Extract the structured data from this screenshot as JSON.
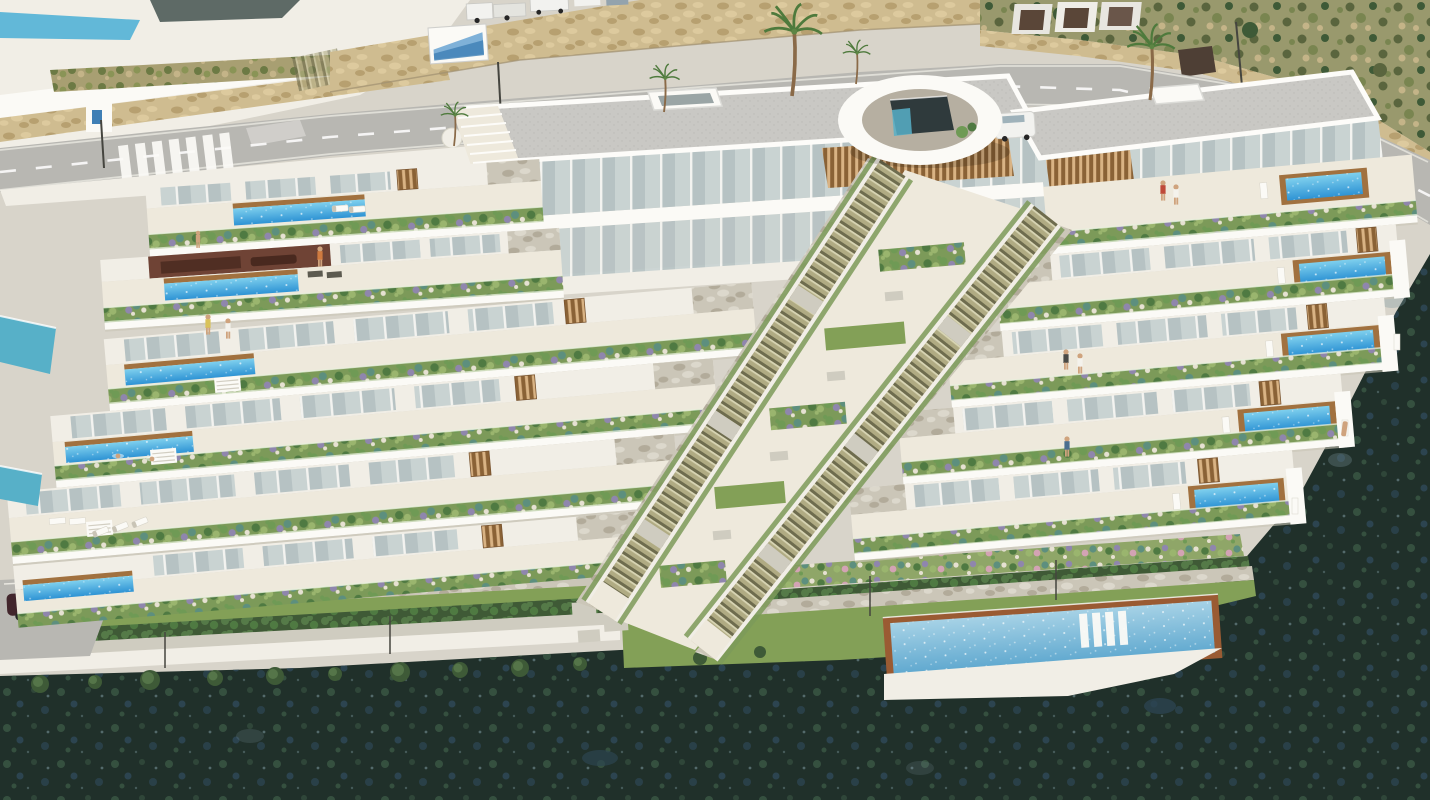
{
  "meta": {
    "type": "architectural-render",
    "view": "aerial",
    "subject": "Terraced hillside residential complex with private pools",
    "aria_label": "Aerial 3D architectural rendering of a white terraced apartment complex built into a coastal hillside: stepped garden terraces with private pools, two central outdoor staircases, an oval entrance pavilion, a road with crosswalk and stone retaining walls above, and dark Mediterranean vegetation below",
    "width": 1430,
    "height": 800
  },
  "scene": {
    "setting": "Sunlit Mediterranean hillside, daylight",
    "landmarks": [
      {
        "name": "existing-villas",
        "description": "White neighbouring villas with pool at top-left corner"
      },
      {
        "name": "main-road",
        "description": "Asphalt road curving across the top with dashed centre line"
      },
      {
        "name": "crosswalk",
        "description": "Zebra pedestrian crossing on the left road section"
      },
      {
        "name": "retaining-wall",
        "description": "Beige rubble-stone retaining wall above the road"
      },
      {
        "name": "billboard",
        "description": "White advertising board mounted on the stone wall"
      },
      {
        "name": "hillside-scrub",
        "description": "Dry scrub slope with stone wall at top right"
      },
      {
        "name": "building-a",
        "description": "Left top building with grey flat roof, skylight, glass facade and timber louvres"
      },
      {
        "name": "building-b",
        "description": "Right top building with grey flat roof, skylight and timber louvres"
      },
      {
        "name": "entrance-pavilion",
        "description": "White oval canopy with glass lift core between the buildings"
      },
      {
        "name": "central-staircases",
        "description": "Two long parallel outdoor staircases descending through the complex"
      },
      {
        "name": "west-terraces",
        "description": "Upper-left terrace rows with linear lap pools and spa lounge"
      },
      {
        "name": "left-wing-terraces",
        "description": "Stepped terrace bands with planted edges and lap pools at their left ends"
      },
      {
        "name": "right-wing-terraces",
        "description": "Stepped terrace bands with square private pools and timber decks at their right ends"
      },
      {
        "name": "communal-pool",
        "description": "Large shared pool with terracotta coping and in-water loungers at the bottom right"
      },
      {
        "name": "lower-gardens",
        "description": "Lawns, flower beds, hedges, stepping stones and tree row at the base"
      },
      {
        "name": "dark-hillside",
        "description": "Dark green natural vegetation wrapping the bottom and right edges"
      }
    ],
    "counts": {
      "terrace_levels_left_wing": 6,
      "terrace_levels_right_wing": 5,
      "private_pools": 10,
      "communal_pools": 1,
      "staircases": 2,
      "palm_trees": 5,
      "parked_vehicles": 7,
      "people": 12,
      "sun_loungers": 10
    },
    "vehicles": [
      "white trucks on upper road",
      "white delivery van",
      "white car",
      "dark red car on lower access road"
    ],
    "vegetation": [
      "round clipped shrubs in terrace planters",
      "purple and teal ornamental bushes",
      "hedgerows",
      "lawn bands",
      "palm trees",
      "dense dark maquis"
    ]
  },
  "palette": {
    "bg": "#d8d4ca",
    "asphalt": "#b8b7b2",
    "roadLine": "#ffffff",
    "roadEdge": "#e9e7e0",
    "white": "#fbfaf6",
    "offWhite": "#f1eee6",
    "deck": "#eee9dc",
    "fasciaShadow": "#c9c4b6",
    "roof": "#c9c8c4",
    "roofDot": "#bcbbb7",
    "glass": "#b6c2c3",
    "glassLight": "#c9d3d2",
    "mullion": "#f3f3f0",
    "wood": "#a1713f",
    "woodDark": "#8a6236",
    "woodLight": "#d9b384",
    "planter": "#7c9a59",
    "lawn": "#83a057",
    "pathGravel": "#cfccc0",
    "padDark": "#8e8a7c",
    "hedgeDark": "#3f5a36",
    "hedgeLight": "#557a48",
    "bushDark": "#4f7a42",
    "bushMid": "#6f9a55",
    "bushLight": "#9ab56e",
    "bushPurple": "#8f86ad",
    "bushTeal": "#5d8f7e",
    "stoneWhite": "#e6e1d2",
    "flowerPink": "#d3a3b4",
    "stoneTan": "#cfbc90",
    "stoneTanDark": "#b7a070",
    "stoneTanLight": "#ddca9e",
    "stoneGray": "#cbc6b8",
    "stoneGrayDark": "#b2ab9a",
    "stoneGrayLight": "#dcd8cc",
    "scrubBase": "#99996d",
    "scrubDark": "#5a653e",
    "scrubMid": "#798550",
    "rock": "#c4b488",
    "treeDark": "#3e5a37",
    "treeMid": "#557549",
    "darkVeg": "#20302a",
    "darkVegLit": "#35503f",
    "darkVegBlue": "#2c4450",
    "speck": "#7e98a0",
    "poolDeep": "#2e93d4",
    "poolLight": "#7fd0ee",
    "poolPale": "#a6d2e6",
    "poolPaleDeep": "#5fa8cf",
    "poolCoping": "#9a5b33",
    "teal": "#57b0c8",
    "steps": "#b0ab83",
    "stepDark": "#6e6c4e",
    "stepLight": "#d8d5b4",
    "skin": "#cfa37d",
    "spaWall": "#6f4335",
    "spaDark": "#49291f",
    "carBody": "#42262c",
    "carRoof": "#5f3d44",
    "vehicleWhite": "#f2f2ef",
    "vehicleGlass": "#9fb2ba",
    "wheel": "#262626",
    "lamp": "#45453f",
    "ringInner": "#b6afa1",
    "cubeDark": "#2f3a3c",
    "clothRed": "#bf4a3a",
    "clothWhite": "#f4f2ec",
    "clothYellow": "#d9c25a",
    "clothBlue": "#4a6f8f",
    "clothOrange": "#d07a3f",
    "clothDark": "#4a4a46",
    "loungerDark": "#5c5a50",
    "oliveBase": "#a89f72",
    "oliveDark": "#6c7a44",
    "oliveMid": "#8a9456",
    "palmTrunk": "#8a6a48",
    "palmFrond": "#4e7a3c"
  }
}
